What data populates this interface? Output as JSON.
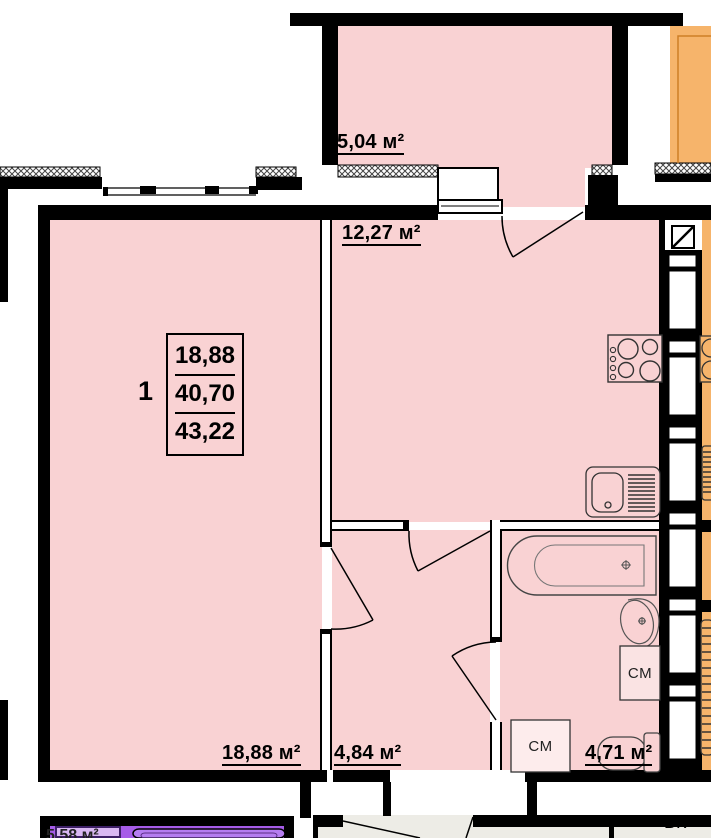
{
  "plan_type": "apartment-floor-plan",
  "labels": {
    "balcony": "5,04 м²",
    "kitchen": "12,27 м²",
    "living_room": "18,88 м²",
    "hallway": "4,84 м²",
    "bathroom": "4,71 м²",
    "washing_machine_1": "СМ",
    "washing_machine_2": "СМ",
    "corridor_riser": "ВК",
    "neighbor_apartment_partial": "5,58 м²"
  },
  "info_box": {
    "rooms_count": "1",
    "row1": "18,88",
    "row2": "40,70",
    "row3": "43,22"
  },
  "colors": {
    "room_fill": "#f9d2d3",
    "fixture_box_fill": "#fae3e3",
    "fixture_box_fill_light": "#fdecec",
    "neighbor_orange": "#f6b46b",
    "neighbor_purple": "#a65ce8",
    "neighbor_purple_light": "#d9b8f2",
    "corridor_grey": "#edece6",
    "wall": "#000000"
  }
}
